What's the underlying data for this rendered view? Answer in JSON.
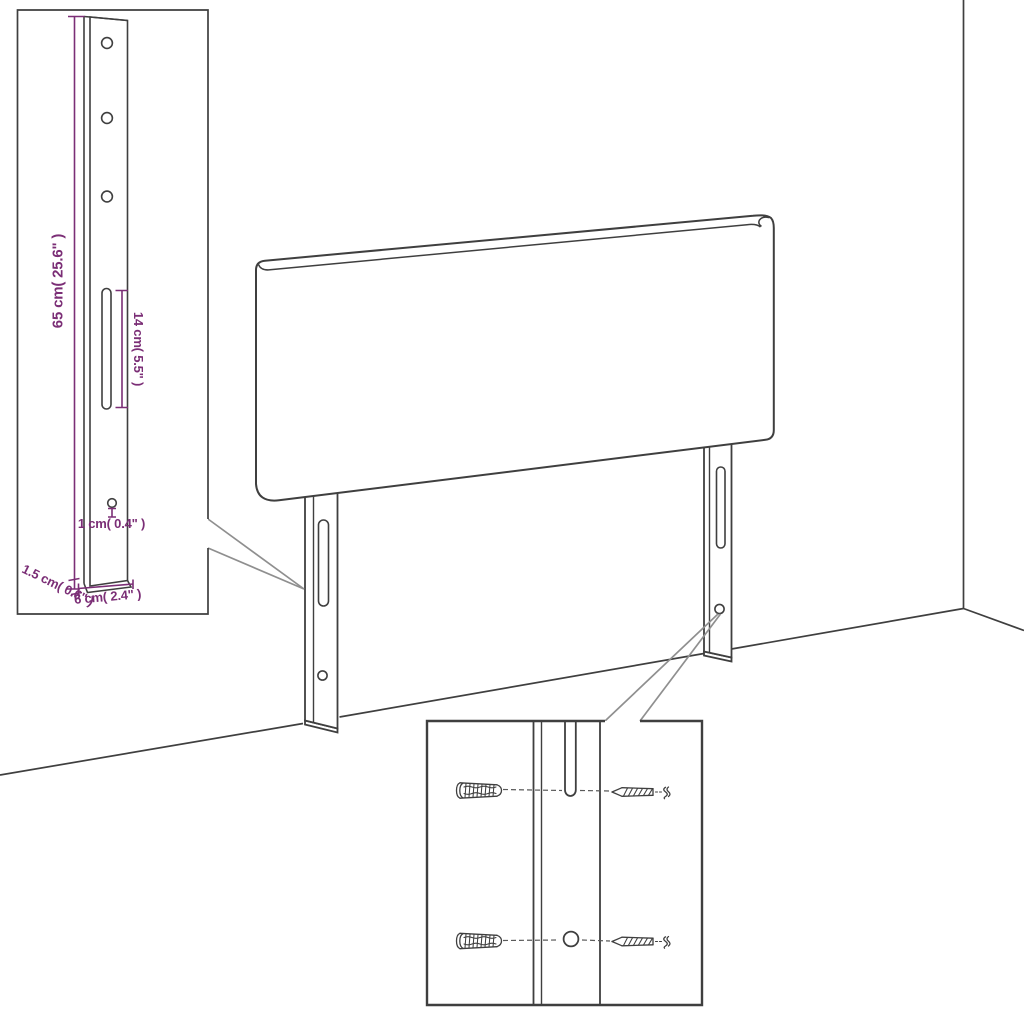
{
  "colors": {
    "line": "#3f3f3f",
    "dimension": "#7b2e76",
    "callout": "#8f8f8f",
    "dash": "#5a5a5a",
    "background": "#ffffff"
  },
  "bracket_detail": {
    "height_label": "65 cm( 25.6\" )",
    "slot_label": "14 cm( 5.5\" )",
    "hole_label": "1 cm( 0.4\" )",
    "thickness_label": "1.5 cm( 0.6\" )",
    "width_label": "6 cm( 2.4\" )",
    "holes_count": "3"
  },
  "main_view": {
    "legs_count": "2"
  },
  "mounting_detail": {
    "wall_plugs_count": "2",
    "screws_count": "2"
  }
}
